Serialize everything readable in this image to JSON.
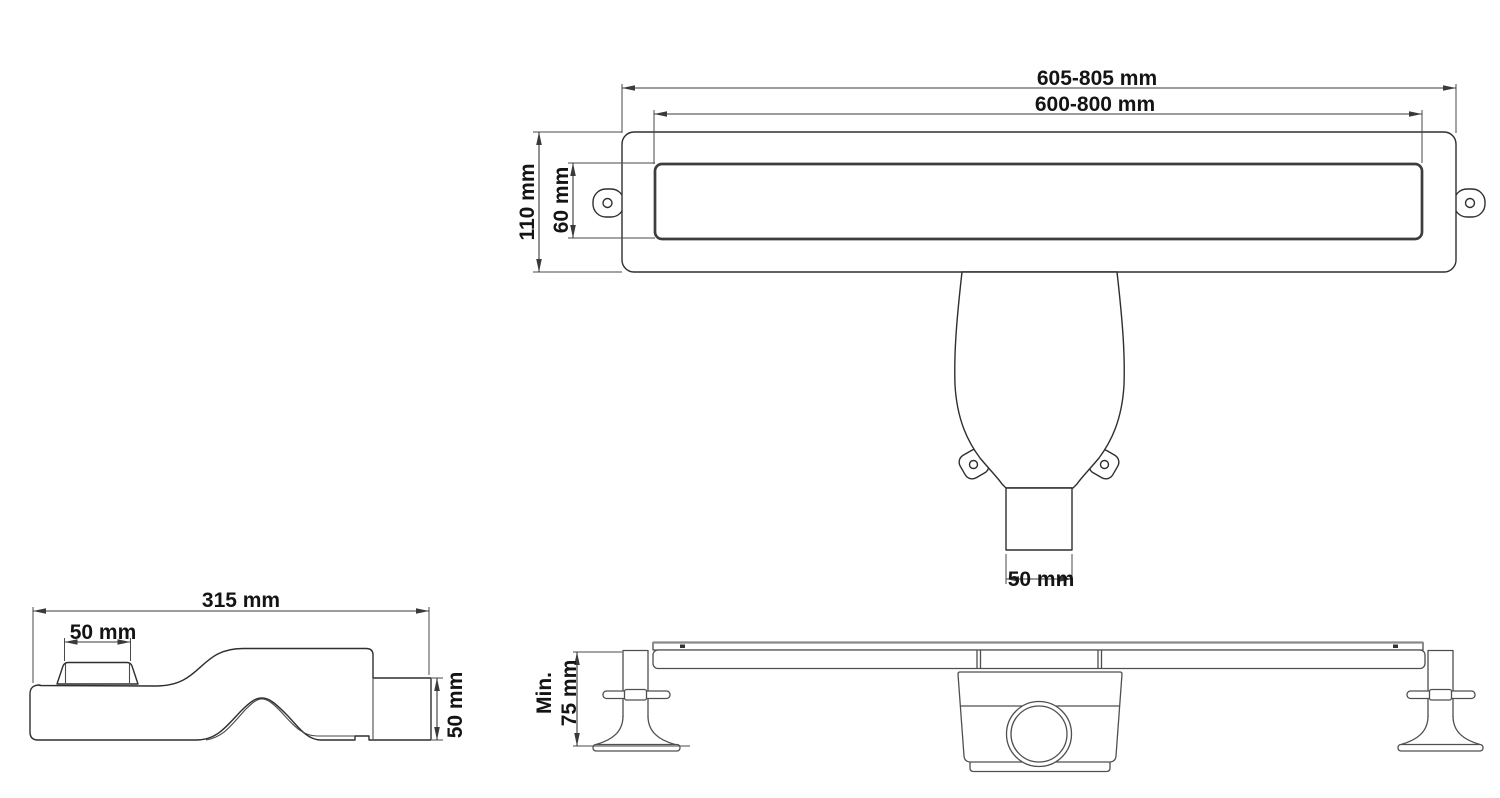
{
  "drawing_title": "linear-shower-drain-dimension-drawing",
  "colors": {
    "background": "#ffffff",
    "line": "#2f2f2f",
    "grate_line": "#3d3d3d",
    "elevation_line": "#4f4f4f",
    "text": "#141414"
  },
  "plan_view": {
    "dims": {
      "outer_length": "605-805 mm",
      "cutout_length": "600-800 mm",
      "body_width": "110 mm",
      "grate_width": "60 mm",
      "outlet_width": "50 mm"
    }
  },
  "side_view": {
    "dims": {
      "trap_length": "315 mm",
      "inlet_width": "50 mm",
      "outlet_height": "50 mm"
    }
  },
  "front_view": {
    "dims": {
      "min_height_prefix": "Min.",
      "min_height_value": "75 mm"
    }
  }
}
